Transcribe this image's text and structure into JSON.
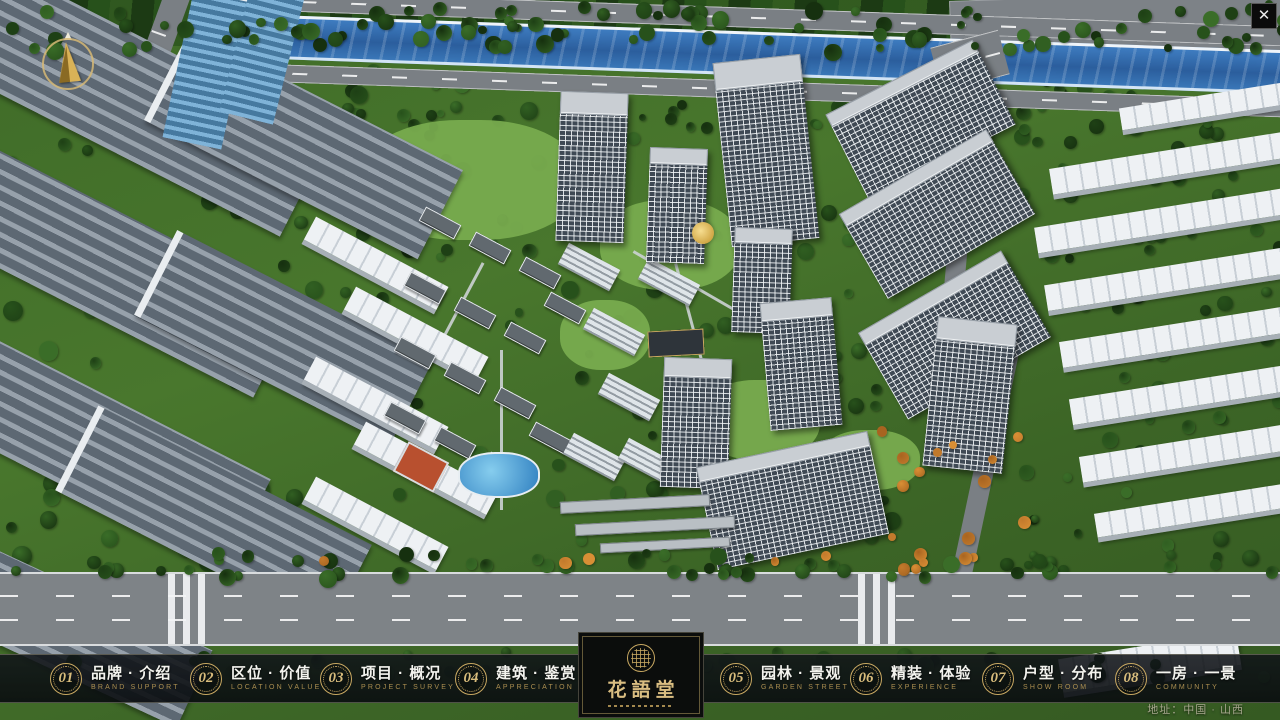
{
  "window": {
    "close_glyph": "✕"
  },
  "logo": {
    "title": "花語堂"
  },
  "address": "地址：中国 · 山西",
  "colors": {
    "accent_gold": "#c9a962",
    "navbar_bg": "#0b0e11",
    "river_blue": "#2f6bad"
  },
  "nav": {
    "items": [
      {
        "num": "01",
        "zh": "品牌 · 介绍",
        "en": "BRAND SUPPORT"
      },
      {
        "num": "02",
        "zh": "区位 · 价值",
        "en": "LOCATION VALUE"
      },
      {
        "num": "03",
        "zh": "项目 · 概况",
        "en": "PROJECT SURVEY"
      },
      {
        "num": "04",
        "zh": "建筑 · 鉴赏",
        "en": "APPRECIATION"
      },
      {
        "num": "05",
        "zh": "园林 · 景观",
        "en": "GARDEN STREET"
      },
      {
        "num": "06",
        "zh": "精装 · 体验",
        "en": "EXPERIENCE"
      },
      {
        "num": "07",
        "zh": "户型 · 分布",
        "en": "SHOW ROOM"
      },
      {
        "num": "08",
        "zh": "一房 · 一景",
        "en": "COMMUNITY"
      }
    ]
  }
}
